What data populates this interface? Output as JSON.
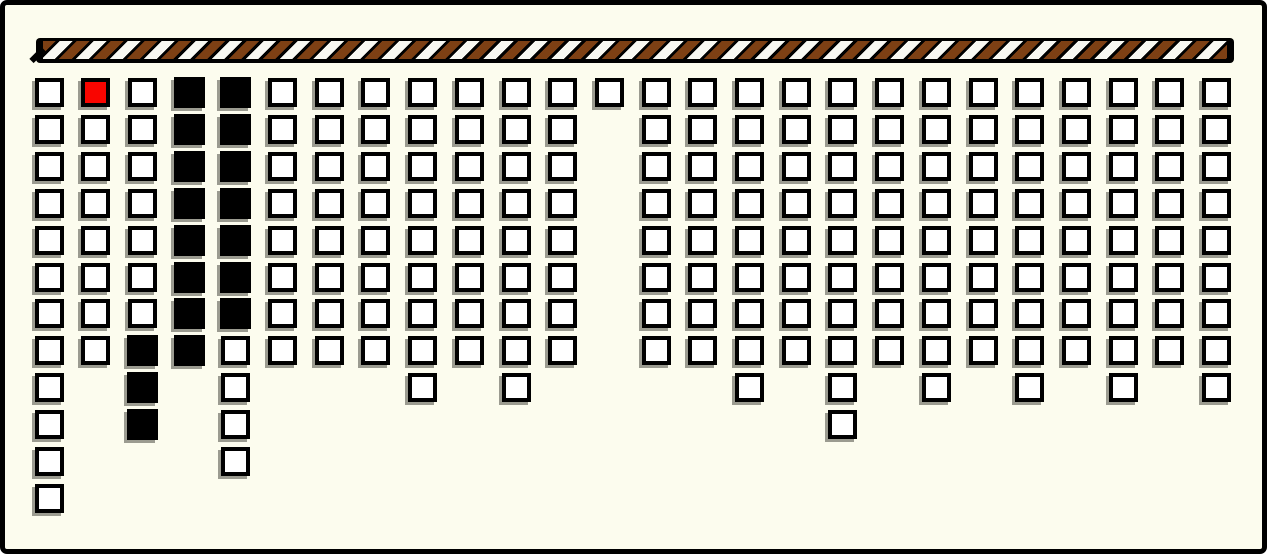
{
  "window": {
    "width": 1267,
    "height": 554,
    "background_color": "#FCFCEE",
    "frame_color": "#000000"
  },
  "striped_bar": {
    "background": "#000000",
    "stripe_brown": "#7D4014",
    "stripe_white": "#F8F8F2"
  },
  "grid": {
    "columns_count": 26,
    "rows_max": 12,
    "cell_colors": {
      "W": "#FFFFFF",
      "B": "#000000",
      "R": "#F90500"
    },
    "columns": [
      "WWWWWWWWWWWW",
      "RWWWWWWW",
      "WWWWWWWBBB",
      "BBBBBBBB",
      "BBBBBBBWWWW",
      "WWWWWWWW",
      "WWWWWWWW",
      "WWWWWWWW",
      "WWWWWWWWW",
      "WWWWWWWW",
      "WWWWWWWWW",
      "WWWWWWWW",
      "W",
      "WWWWWWWW",
      "WWWWWWWW",
      "WWWWWWWWW",
      "WWWWWWWW",
      "WWWWWWWWWW",
      "WWWWWWWW",
      "WWWWWWWWW",
      "WWWWWWWW",
      "WWWWWWWWW",
      "WWWWWWWW",
      "WWWWWWWWW",
      "WWWWWWWW",
      "WWWWWWWWW"
    ]
  }
}
